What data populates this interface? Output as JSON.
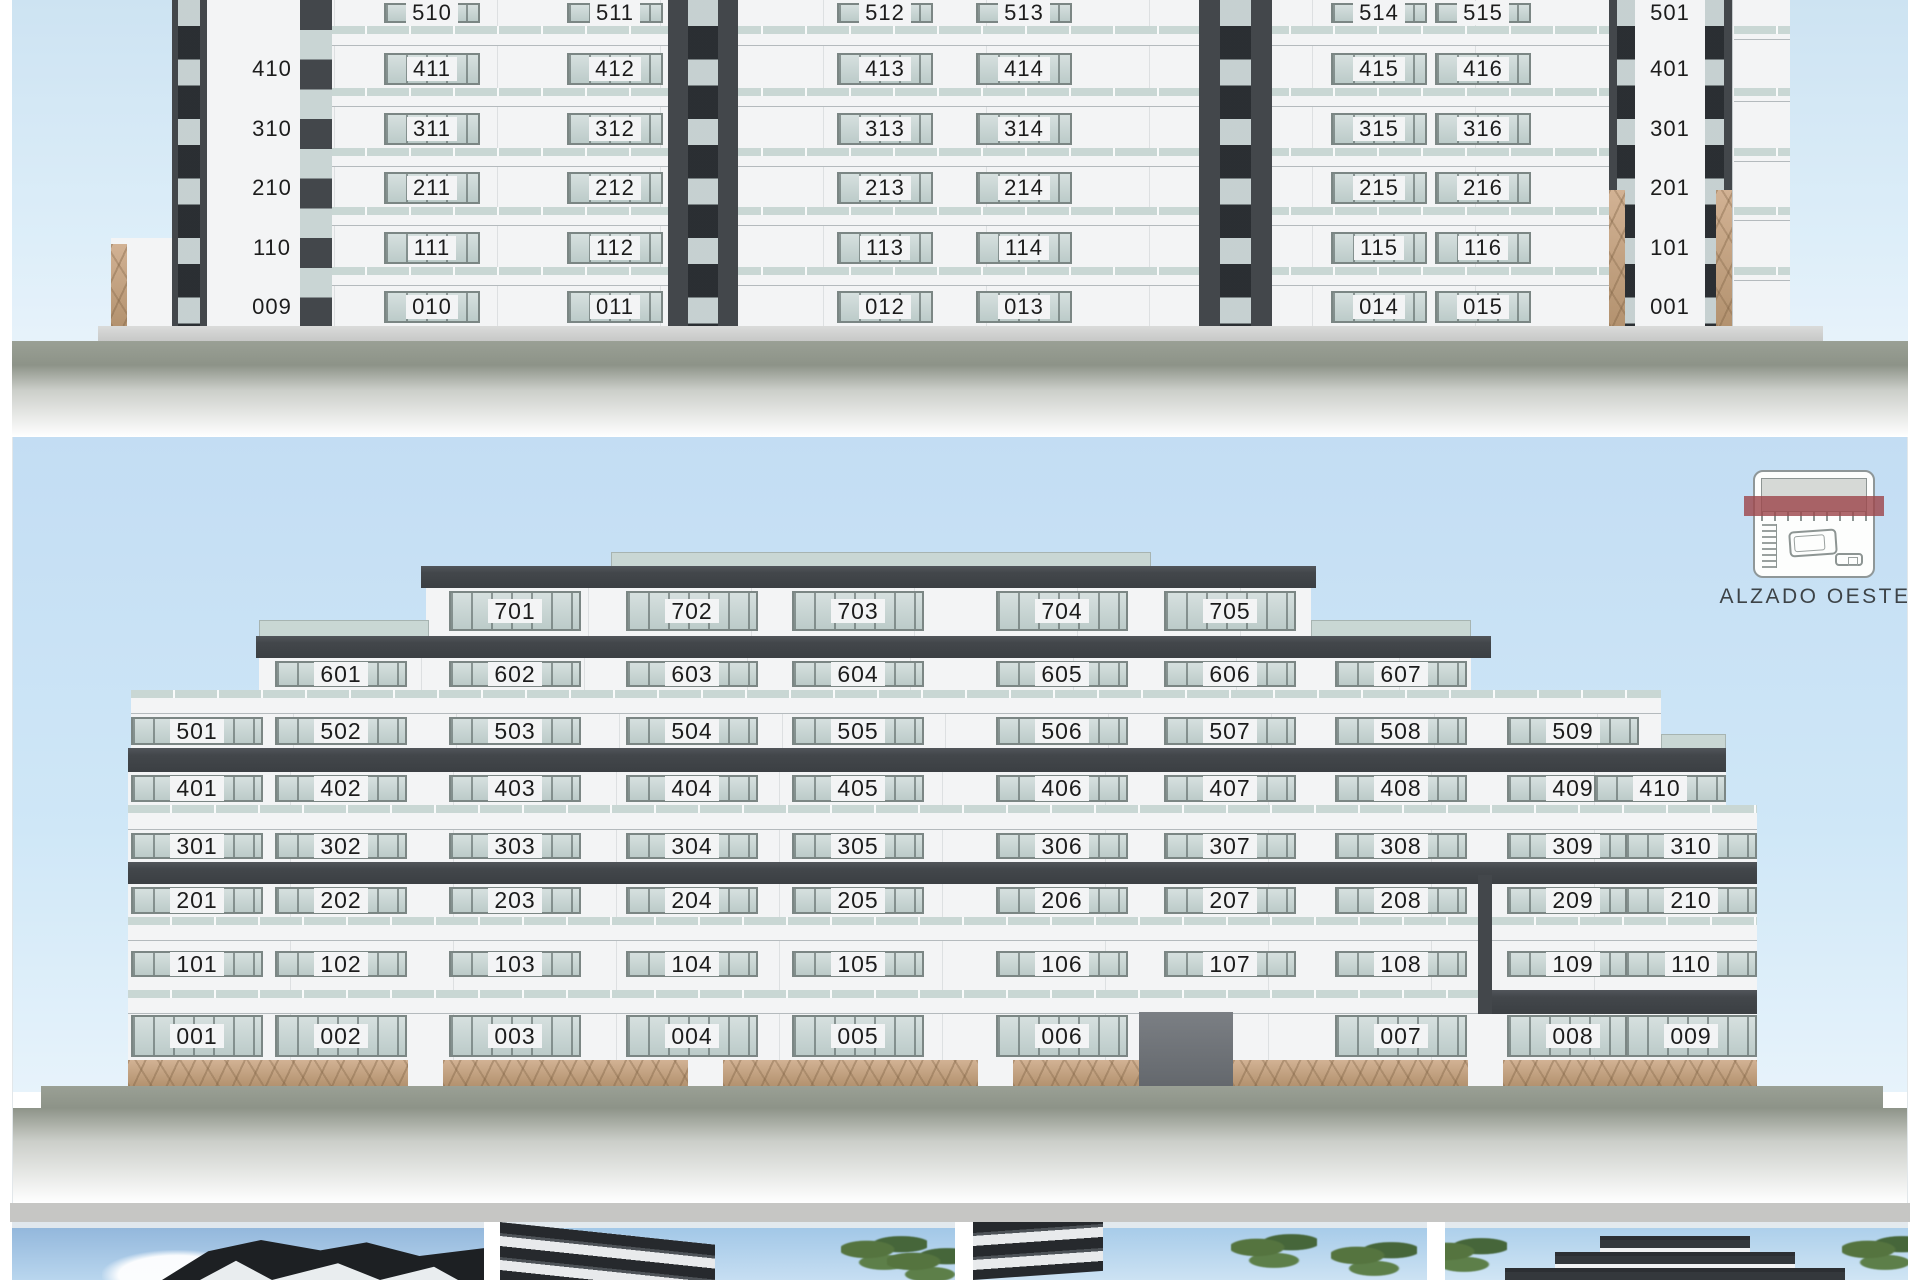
{
  "sheet": {
    "title": "ALZADO OESTE"
  },
  "colors": {
    "sky_top": "#cde3f2",
    "sky_main": "#c3ddf3",
    "facade": "#f3f4f5",
    "dark": "#43474b",
    "glass_hi": "#d6e0df",
    "glass_lo": "#bccbc9",
    "frame": "#7b8684",
    "rail": "#c9d7d4",
    "stone_light": "#d2b294",
    "stone_dark": "#b3926f",
    "ground": "#8d9388",
    "ground_light": "#c7c8c7",
    "ink": "#1c1c1c",
    "strip_gray": "#c6c6c4",
    "legend_red": "#9d484d",
    "legend_ink": "#3d4347"
  },
  "top_elevation": {
    "floors": [
      {
        "units": [
          null,
          "510",
          "511",
          "512",
          "513",
          "514",
          "515",
          "501"
        ]
      },
      {
        "units": [
          "410",
          "411",
          "412",
          "413",
          "414",
          "415",
          "416",
          "401"
        ]
      },
      {
        "units": [
          "310",
          "311",
          "312",
          "313",
          "314",
          "315",
          "316",
          "301"
        ]
      },
      {
        "units": [
          "210",
          "211",
          "212",
          "213",
          "214",
          "215",
          "216",
          "201"
        ]
      },
      {
        "units": [
          "110",
          "111",
          "112",
          "113",
          "114",
          "115",
          "116",
          "101"
        ]
      },
      {
        "units": [
          "009",
          "010",
          "011",
          "012",
          "013",
          "014",
          "015",
          "001"
        ]
      }
    ]
  },
  "main_elevation": {
    "label": "ALZADO OESTE",
    "floors": [
      {
        "level": "7",
        "start_col": 2,
        "units": [
          "701",
          "702",
          "703",
          "704",
          "705"
        ]
      },
      {
        "level": "6",
        "start_col": 1,
        "units": [
          "601",
          "602",
          "603",
          "604",
          "605",
          "606",
          "607"
        ]
      },
      {
        "level": "5",
        "start_col": 0,
        "units": [
          "501",
          "502",
          "503",
          "504",
          "505",
          "506",
          "507",
          "508",
          "509"
        ]
      },
      {
        "level": "4",
        "start_col": 0,
        "units": [
          "401",
          "402",
          "403",
          "404",
          "405",
          "406",
          "407",
          "408",
          "409",
          "410"
        ]
      },
      {
        "level": "3",
        "start_col": 0,
        "units": [
          "301",
          "302",
          "303",
          "304",
          "305",
          "306",
          "307",
          "308",
          "309",
          "310"
        ]
      },
      {
        "level": "2",
        "start_col": 0,
        "units": [
          "201",
          "202",
          "203",
          "204",
          "205",
          "206",
          "207",
          "208",
          "209",
          "210"
        ]
      },
      {
        "level": "1",
        "start_col": 0,
        "units": [
          "101",
          "102",
          "103",
          "104",
          "105",
          "106",
          "107",
          "108",
          "109",
          "110"
        ]
      },
      {
        "level": "0",
        "start_col": 0,
        "units": [
          "001",
          "002",
          "003",
          "004",
          "005",
          "006",
          null,
          "007",
          "008",
          "009"
        ]
      }
    ]
  },
  "thumbnails": [
    {
      "name": "render-corner-tower"
    },
    {
      "name": "render-facade-closeup-palms"
    },
    {
      "name": "render-street-palms"
    },
    {
      "name": "render-west-front-palms"
    }
  ]
}
